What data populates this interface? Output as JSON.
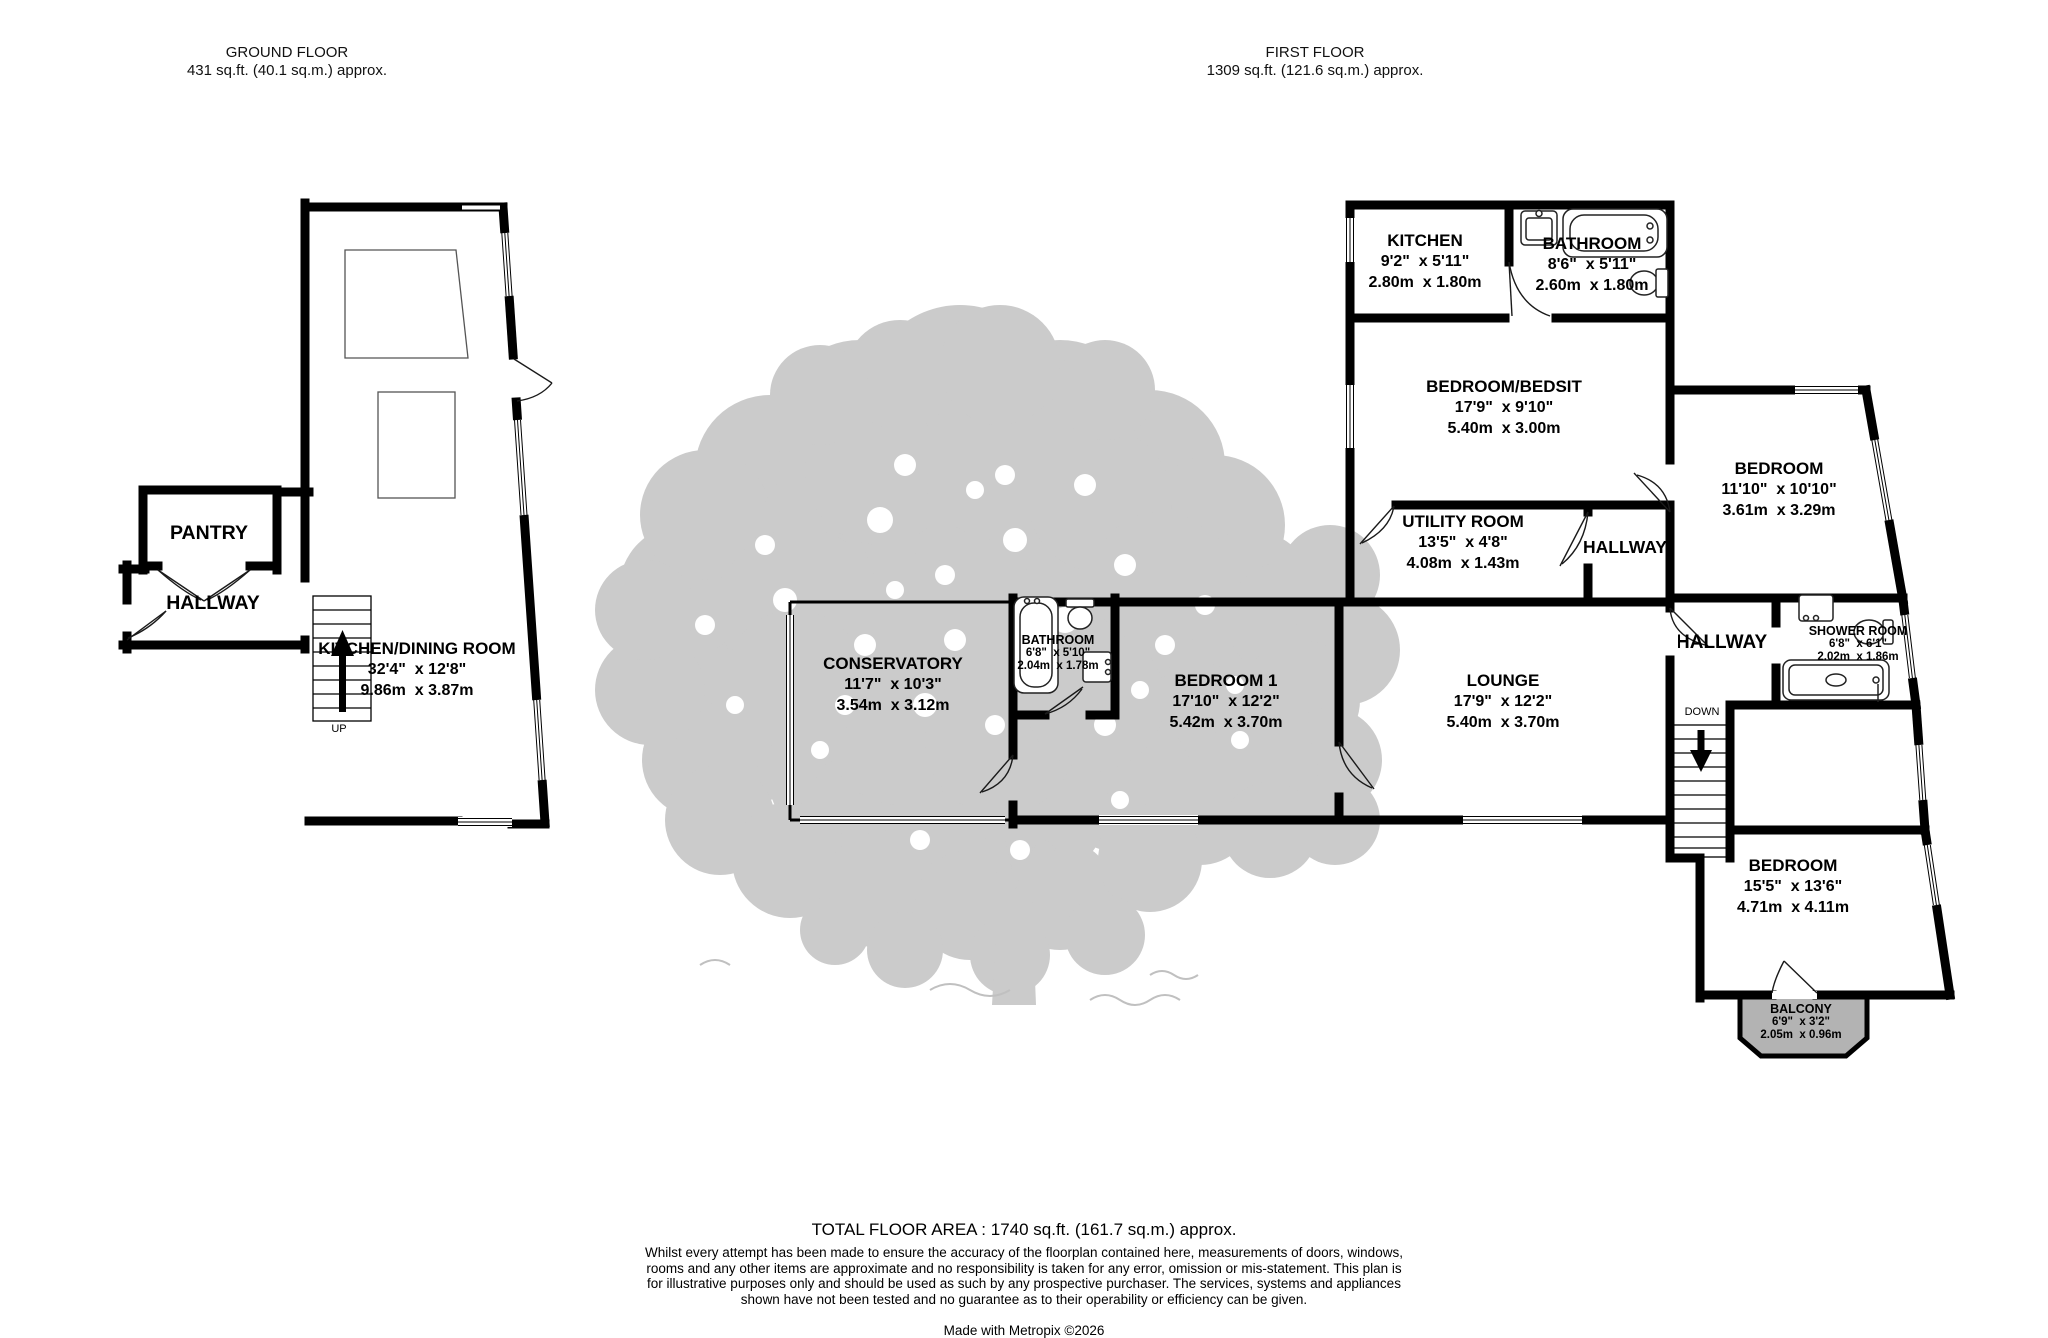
{
  "header": {
    "ground_floor": {
      "title": "GROUND FLOOR",
      "area": "431 sq.ft. (40.1 sq.m.) approx."
    },
    "first_floor": {
      "title": "FIRST FLOOR",
      "area": "1309 sq.ft. (121.6 sq.m.) approx."
    }
  },
  "rooms": {
    "pantry": {
      "name": "PANTRY"
    },
    "hallway_gf": {
      "name": "HALLWAY"
    },
    "kitchen_dining": {
      "name": "KITCHEN/DINING ROOM",
      "ft": "32'4\"  x 12'8\"",
      "m": "9.86m  x 3.87m"
    },
    "conservatory": {
      "name": "CONSERVATORY",
      "ft": "11'7\"  x 10'3\"",
      "m": "3.54m  x 3.12m"
    },
    "bathroom_main": {
      "name": "BATHROOM",
      "ft": "6'8\"  x 5'10\"",
      "m": "2.04m  x 1.78m"
    },
    "bedroom1": {
      "name": "BEDROOM 1",
      "ft": "17'10\"  x 12'2\"",
      "m": "5.42m  x 3.70m"
    },
    "lounge": {
      "name": "LOUNGE",
      "ft": "17'9\"  x 12'2\"",
      "m": "5.40m  x 3.70m"
    },
    "kitchen": {
      "name": "KITCHEN",
      "ft": "9'2\"  x 5'11\"",
      "m": "2.80m  x 1.80m"
    },
    "bathroom_ff": {
      "name": "BATHROOM",
      "ft": "8'6\"  x 5'11\"",
      "m": "2.60m  x 1.80m"
    },
    "bedroom_bedsit": {
      "name": "BEDROOM/BEDSIT",
      "ft": "17'9\"  x 9'10\"",
      "m": "5.40m  x 3.00m"
    },
    "utility": {
      "name": "UTILITY ROOM",
      "ft": "13'5\"  x 4'8\"",
      "m": "4.08m  x 1.43m"
    },
    "hallway_ff1": {
      "name": "HALLWAY"
    },
    "bedroom_ne": {
      "name": "BEDROOM",
      "ft": "11'10\"  x 10'10\"",
      "m": "3.61m  x 3.29m"
    },
    "hallway_ff2": {
      "name": "HALLWAY"
    },
    "shower": {
      "name": "SHOWER ROOM",
      "ft": "6'8\"  x 6'1\"",
      "m": "2.02m  x 1.86m"
    },
    "bedroom_se": {
      "name": "BEDROOM",
      "ft": "15'5\"  x 13'6\"",
      "m": "4.71m  x 4.11m"
    },
    "balcony": {
      "name": "BALCONY",
      "ft": "6'9\"  x 3'2\"",
      "m": "2.05m  x 0.96m"
    }
  },
  "stairs": {
    "up": "UP",
    "down": "DOWN"
  },
  "footer": {
    "total": "TOTAL FLOOR AREA : 1740 sq.ft. (161.7 sq.m.) approx.",
    "disclaimer": "Whilst every attempt has been made to ensure the accuracy of the floorplan contained here, measurements of doors, windows, rooms and any other items are approximate and no responsibility is taken for any error, omission or mis-statement. This plan is for illustrative purposes only and should be used as such by any prospective purchaser. The services, systems and appliances shown have not been tested and no guarantee as to their operability or efficiency can be given.",
    "credit": "Made with Metropix ©2026"
  },
  "colors": {
    "wall": "#000000",
    "foliage": "#cbcbcb",
    "balcony_fill": "#b3b3b3"
  }
}
